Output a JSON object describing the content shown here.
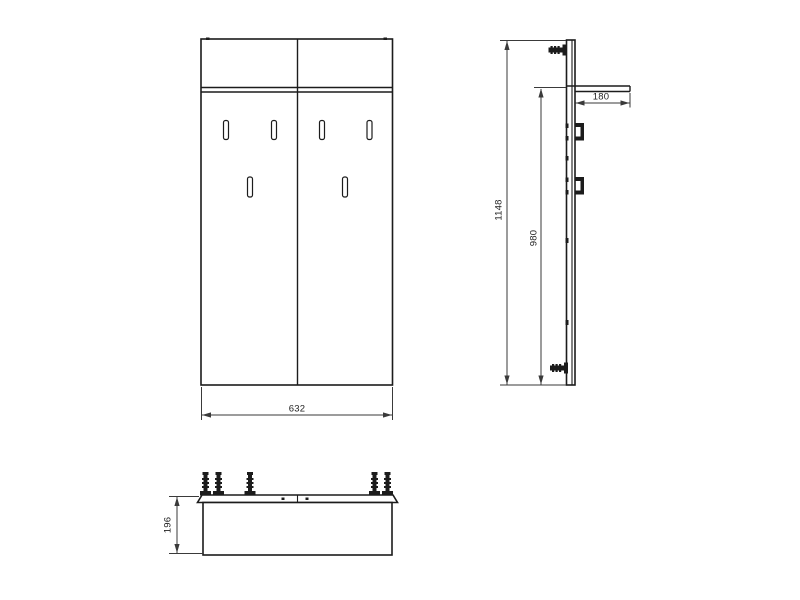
{
  "drawing": {
    "colors": {
      "line": "#1c1c1c",
      "dim": "#3a3a3a",
      "bg": "#ffffff"
    },
    "dimensions": {
      "front_width": "632",
      "total_height": "1148",
      "panel_height": "980",
      "shelf_depth": "180",
      "bench_depth": "196"
    }
  }
}
